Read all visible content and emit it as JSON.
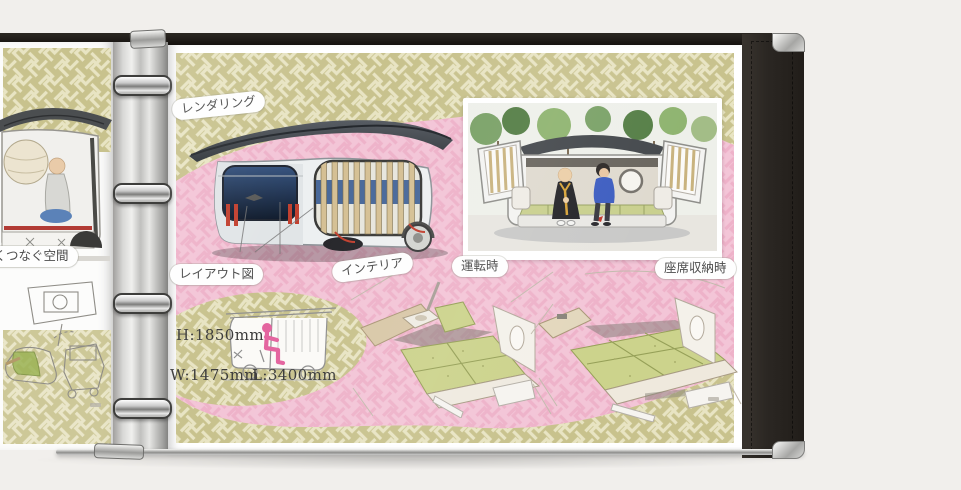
{
  "left_page": {
    "caption": "るくつなぐ空間"
  },
  "right_page": {
    "labels": {
      "rendering": "レンダリング",
      "layout_diagram": "レイアウト図",
      "interior": "インテリア",
      "while_driving": "運転時",
      "seats_stowed": "座席収納時"
    },
    "dimensions": {
      "height": "H:1850mm",
      "width": "W:1475mm",
      "length": "L:3400mm"
    }
  },
  "colors": {
    "photo_background": "#f1efec",
    "pattern_green": "#c8c28d",
    "pattern_green_line": "#e8e4c3",
    "pattern_pink": "#f3c5d7",
    "pattern_pink_line": "#eeb2c9",
    "binder_cover": "#2b2723",
    "ring_chrome": "#c9c9c9",
    "roof_gray": "#3f444a",
    "glass_blue": "#2c415f",
    "slat_tan": "#d5c094",
    "tatami_green": "#ccd38c",
    "accent_red": "#c2402f",
    "figure_pink": "#e4649f",
    "monk_robe_black": "#26262a",
    "jacket_blue": "#3e5ec1",
    "label_text": "#4c4c4c"
  }
}
